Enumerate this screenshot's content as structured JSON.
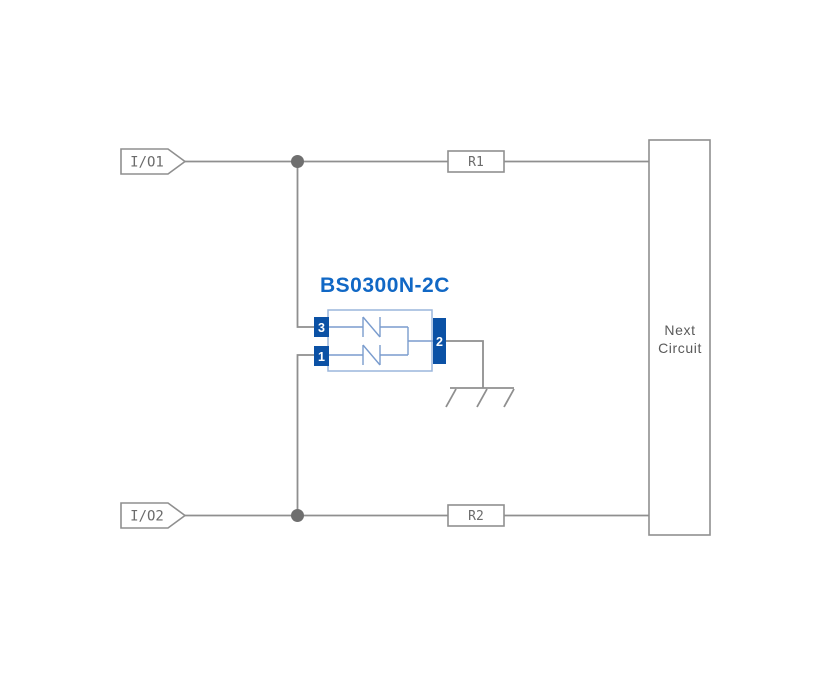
{
  "diagram": {
    "kind": "TVS diode protection circuit schematic",
    "colors": {
      "background": "#ffffff",
      "wire": "#8f8f8f",
      "junction_dot": "#6f6f6f",
      "label_text": "#6b6b6b",
      "component_title": "#1168c5",
      "component_outline": "#9ab5dc",
      "component_inner": "#7a9cce",
      "pin_fill": "#0b51a5",
      "pin_text": "#ffffff"
    },
    "io_tags": {
      "io1": "I/O1",
      "io2": "I/O2"
    },
    "resistors": {
      "r1": "R1",
      "r2": "R2"
    },
    "next_circuit": {
      "line1": "Next",
      "line2": "Circuit"
    },
    "component": {
      "title": "BS0300N-2C",
      "pins": [
        {
          "number": "3"
        },
        {
          "number": "1"
        },
        {
          "number": "2"
        }
      ],
      "elements": "two bidirectional TVS diodes to common pin 2 (ground)"
    },
    "ground": {
      "type": "chassis-ground-symbol"
    }
  }
}
